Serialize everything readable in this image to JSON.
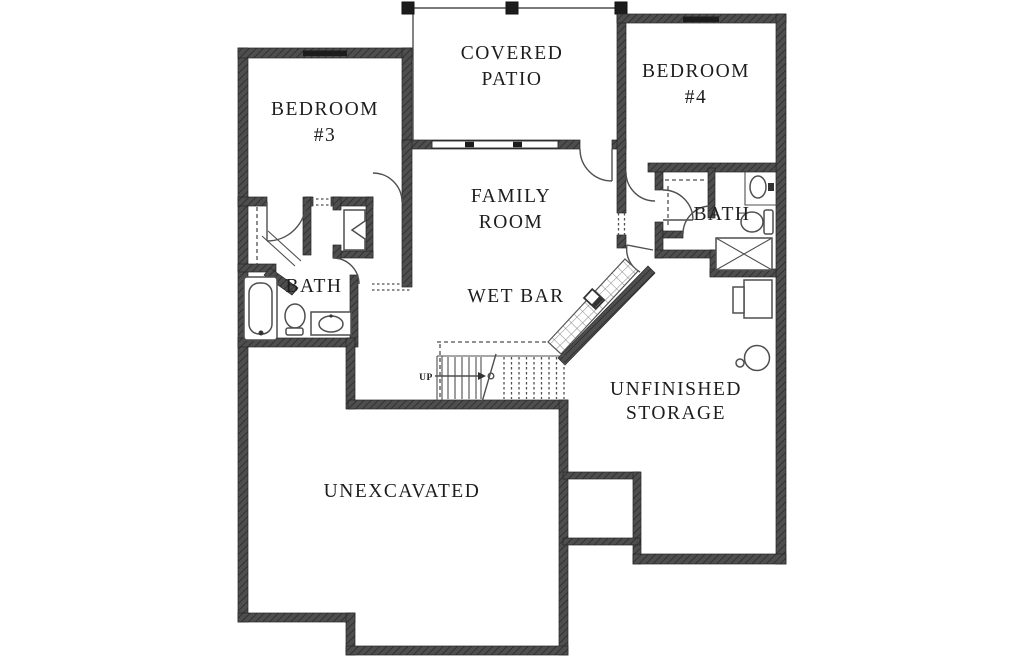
{
  "plan": {
    "rooms": {
      "covered_patio": {
        "line1": "COVERED",
        "line2": "PATIO"
      },
      "bedroom_3": {
        "line1": "BEDROOM",
        "line2": "#3"
      },
      "bedroom_4": {
        "line1": "BEDROOM",
        "line2": "#4"
      },
      "family_room": {
        "line1": "FAMILY",
        "line2": "ROOM"
      },
      "wet_bar": {
        "label": "WET BAR"
      },
      "bath_left": {
        "label": "BATH"
      },
      "bath_right": {
        "label": "BATH"
      },
      "unfinished_storage": {
        "line1": "UNFINISHED",
        "line2": "STORAGE"
      },
      "unexcavated": {
        "label": "UNEXCAVATED"
      },
      "stairs": {
        "label": "UP"
      }
    },
    "colors": {
      "wall": "#4e4e4e",
      "line": "#4f4f4f",
      "text": "#1d1d1d",
      "background": "#ffffff"
    }
  }
}
